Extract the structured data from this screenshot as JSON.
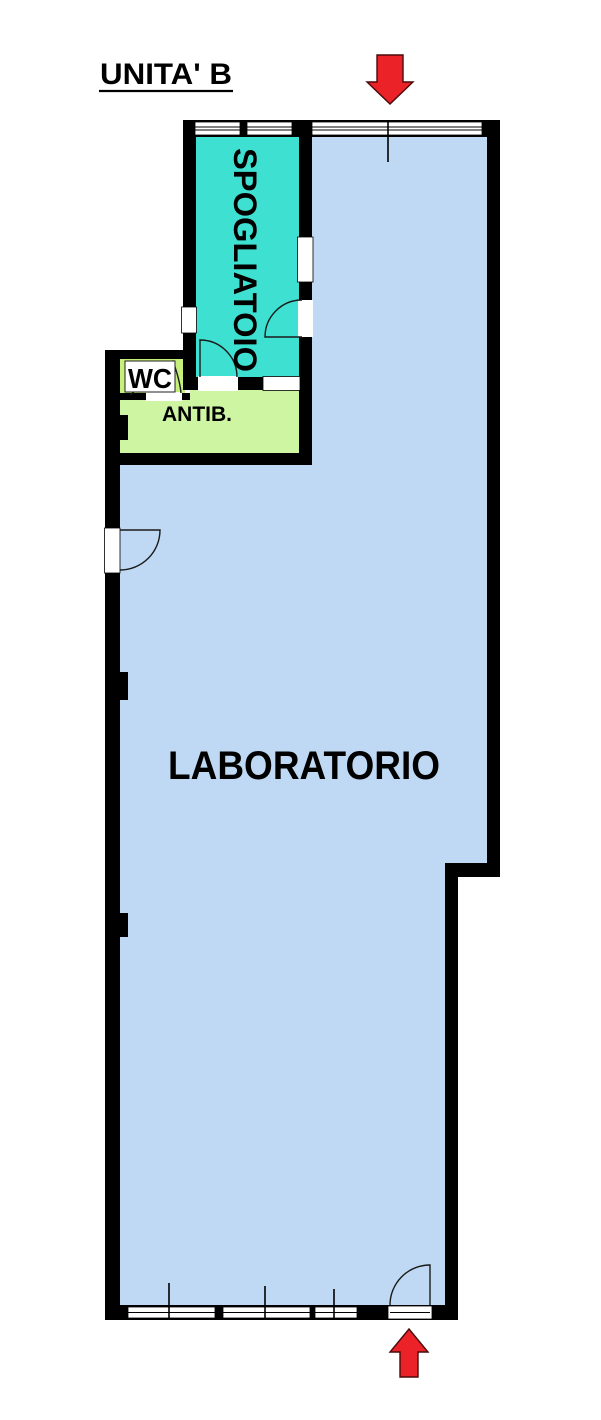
{
  "title": "UNITA' B",
  "rooms": {
    "spogliatoio": {
      "label": "SPOGLIATOIO",
      "fill": "#3EE1D1"
    },
    "wc": {
      "label": "WC",
      "fill": "#C6EF7B"
    },
    "antib": {
      "label": "ANTIB.",
      "fill": "#CDF5A2"
    },
    "laboratorio": {
      "label": "LABORATORIO",
      "fill": "#BFD9F4"
    }
  },
  "colors": {
    "background": "#FFFFFF",
    "wall": "#000000",
    "opening": "#FFFFFF",
    "line": "#1A1A1A",
    "text": "#000000",
    "arrow_fill": "#EB2227",
    "arrow_outline": "#4A0A0C"
  },
  "icons": {
    "entrance_top": "arrow-down-icon",
    "entrance_bottom": "arrow-up-icon"
  }
}
